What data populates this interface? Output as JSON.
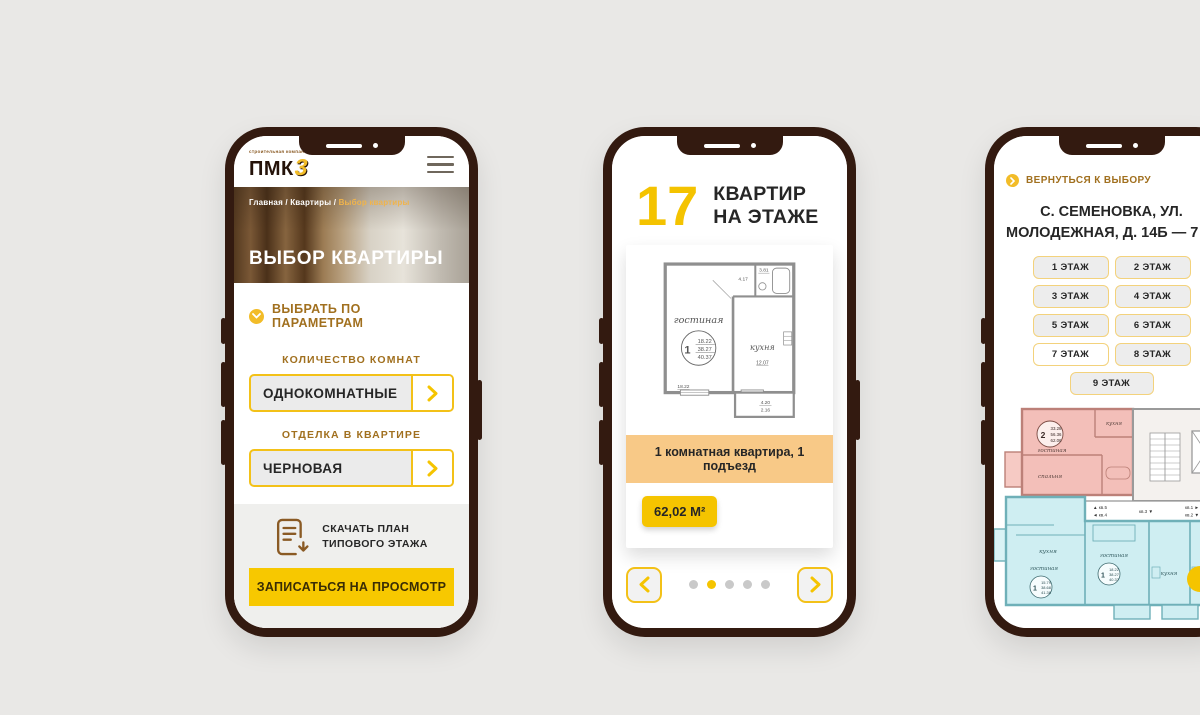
{
  "colors": {
    "accent_yellow": "#f5c400",
    "gold_text": "#a1701f",
    "frame_brown": "#331a10",
    "banner_orange": "#f8c987"
  },
  "phone1": {
    "logo": {
      "tagline": "строительная компания",
      "text": "ПМК",
      "digit": "3"
    },
    "menu_icon": "hamburger",
    "breadcrumb": {
      "path": "Главная / Квартиры /",
      "current": "Выбор квартиры"
    },
    "hero_title": "ВЫБОР КВАРТИРЫ",
    "filter_heading": "ВЫБРАТЬ ПО ПАРАМЕТРАМ",
    "field1": {
      "label": "КОЛИЧЕСТВО КОМНАТ",
      "value": "ОДНОКОМНАТНЫЕ"
    },
    "field2": {
      "label": "ОТДЕЛКА В КВАРТИРЕ",
      "value": "ЧЕРНОВАЯ"
    },
    "download": {
      "line1": "СКАЧАТЬ ПЛАН",
      "line2": "ТИПОВОГО ЭТАЖА"
    },
    "cta": "ЗАПИСАТЬСЯ НА ПРОСМОТР"
  },
  "phone2": {
    "flat_count": "17",
    "flat_count_label1": "КВАРТИР",
    "flat_count_label2": "НА ЭТАЖЕ",
    "plan": {
      "living_room": "гостиная",
      "living_width": "18.22",
      "rooms_num": "1",
      "area_living": "18.22",
      "area_total": "38.27",
      "area_full": "40.37",
      "kitchen": "кухня",
      "kitchen_area": "12.07",
      "hall_area": "4.17",
      "bath_area": "3.81",
      "balcony_width": "4.20",
      "balcony_area": "2.16"
    },
    "banner": "1 комнатная квартира, 1 подъезд",
    "area_badge": "62,02 М²",
    "pagination": {
      "dot_count": 5,
      "active_index": 1
    }
  },
  "phone3": {
    "back_link": "ВЕРНУТЬСЯ К ВЫБОРУ",
    "title1": "С. СЕМЕНОВКА, УЛ.",
    "title2": "МОЛОДЕЖНАЯ, Д. 14Б — 7 ЭТАЖ",
    "floors": [
      "1 ЭТАЖ",
      "2 ЭТАЖ",
      "3 ЭТАЖ",
      "4 ЭТАЖ",
      "5 ЭТАЖ",
      "6 ЭТАЖ",
      "7 ЭТАЖ",
      "8 ЭТАЖ",
      "9 ЭТАЖ"
    ],
    "active_floor": "7 ЭТАЖ",
    "plan": {
      "apt2": {
        "rooms": "2",
        "a1": "33.28",
        "a2": "56.36",
        "a3": "62.06",
        "living": "гостиная",
        "bedroom": "спальня",
        "kitchen": "кухня"
      },
      "apt1a": {
        "rooms": "1",
        "a1": "15.79",
        "a2": "38.68",
        "a3": "41.36",
        "living": "гостиная",
        "kitchen": "кухня"
      },
      "apt1b": {
        "rooms": "1",
        "a1": "18.22",
        "a2": "38.27",
        "a3": "40.37",
        "living": "гостиная",
        "kitchen": "кухня"
      },
      "kitchen_right": "кухня",
      "corridor": {
        "l1": "▲ кв.5",
        "l2": "◄ кв.4",
        "l3": "кв.3 ▼",
        "l4": "кв.1 ►",
        "l5": "кв.2 ▼"
      }
    }
  }
}
